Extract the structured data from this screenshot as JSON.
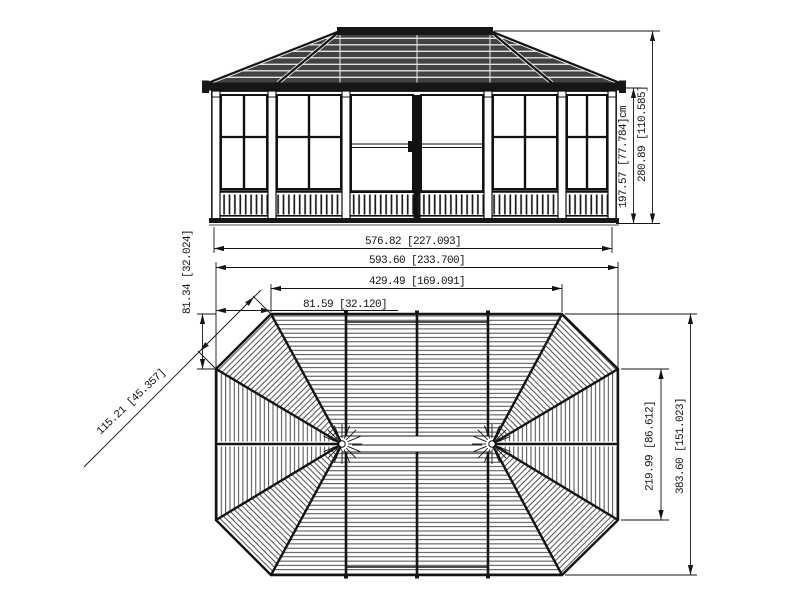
{
  "drawing": {
    "type": "technical-dimension-drawing",
    "subject": "octagonal gazebo / solarium — front elevation and roof plan",
    "ink_color": "#141414",
    "roof_fill": "#424242",
    "background": "#ffffff",
    "units_format": "cm [inches]"
  },
  "dims": {
    "elevation_width": "576.82 [227.093]",
    "elevation_wall_height": "197.57 [77.784]cm",
    "elevation_total_height": "280.89 [110.585]",
    "plan_total_width": "593.60 [233.700]",
    "plan_front_edge": "429.49 [169.091]",
    "plan_corner_run": "81.59 [32.120]",
    "plan_corner_rise": "81.34 [32.024]",
    "plan_corner_edge": "115.21 [45.357]",
    "plan_side_edge": "219.99 [86.612]",
    "plan_total_depth": "383.60 [151.023]"
  }
}
